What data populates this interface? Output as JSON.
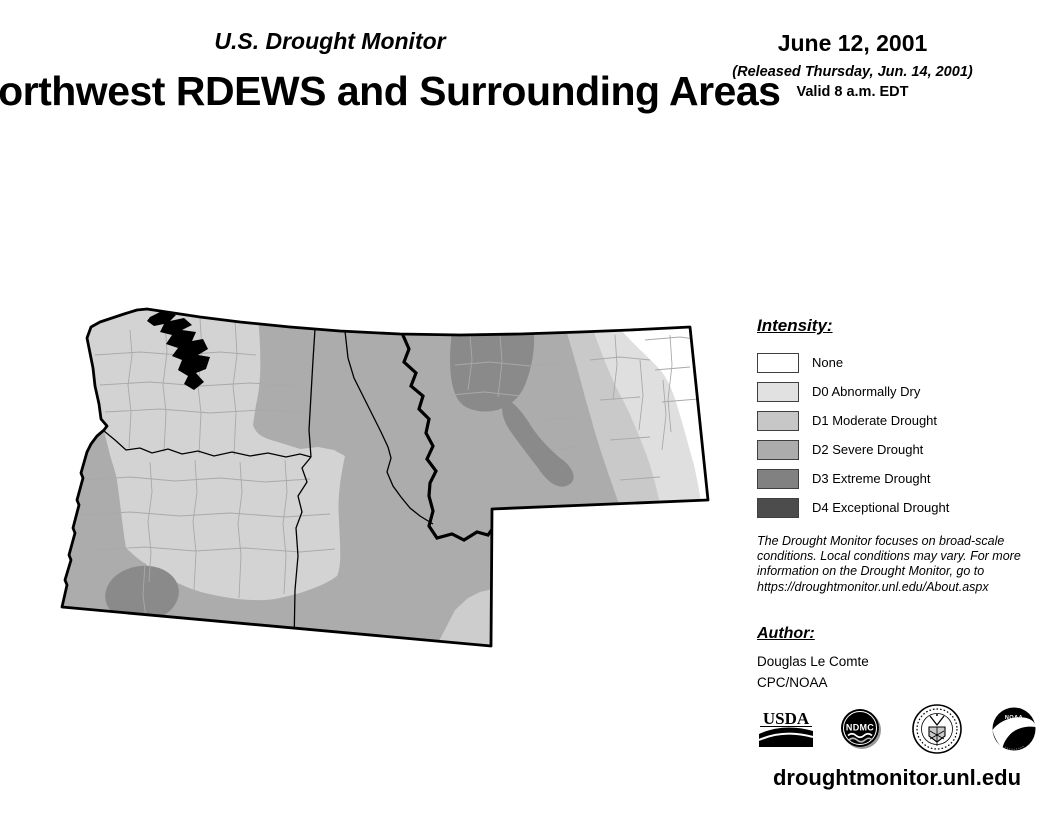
{
  "header": {
    "kicker": "U.S. Drought Monitor",
    "title": "Northwest RDEWS and Surrounding Areas",
    "date": "June 12, 2001",
    "released": "(Released Thursday, Jun. 14, 2001)",
    "valid": "Valid 8 a.m. EDT"
  },
  "legend": {
    "heading": "Intensity:",
    "items": [
      {
        "label": "None",
        "color": "#ffffff"
      },
      {
        "label": "D0 Abnormally Dry",
        "color": "#e1e1e1"
      },
      {
        "label": "D1 Moderate Drought",
        "color": "#c7c7c7"
      },
      {
        "label": "D2 Severe Drought",
        "color": "#acacac"
      },
      {
        "label": "D3 Extreme Drought",
        "color": "#818181"
      },
      {
        "label": "D4 Exceptional Drought",
        "color": "#4c4c4c"
      }
    ]
  },
  "disclaimer": {
    "lines": [
      "The Drought Monitor focuses on broad-scale",
      "conditions. Local conditions may vary. For more",
      "information on the Drought Monitor, go to",
      "https://droughtmonitor.unl.edu/About.aspx"
    ]
  },
  "author": {
    "heading": "Author:",
    "name": "Douglas Le Comte",
    "org": "CPC/NOAA"
  },
  "logos": [
    {
      "id": "usda",
      "text": "USDA"
    },
    {
      "id": "ndmc",
      "text": "NDMC"
    },
    {
      "id": "commerce-seal",
      "text": ""
    },
    {
      "id": "noaa",
      "text": "NOAA"
    }
  ],
  "footer": {
    "url": "droughtmonitor.unl.edu"
  }
}
